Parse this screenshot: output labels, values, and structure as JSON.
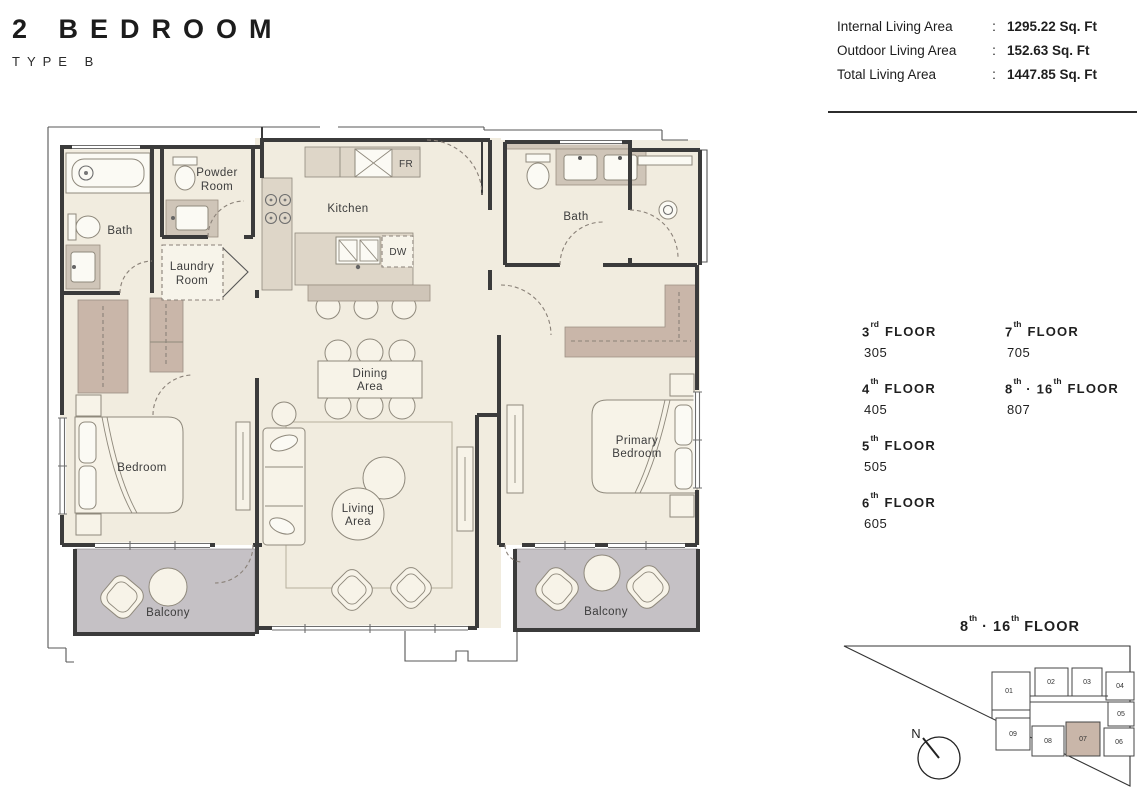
{
  "title": {
    "name": "2 BEDROOM",
    "type": "TYPE B"
  },
  "area_summary": [
    {
      "label": "Internal Living Area",
      "colon": ":",
      "value": "1295.22 Sq. Ft"
    },
    {
      "label": "Outdoor Living Area",
      "colon": ":",
      "value": "152.63 Sq. Ft"
    },
    {
      "label": "Total Living Area",
      "colon": ":",
      "value": "1447.85 Sq. Ft"
    }
  ],
  "floors": {
    "left": [
      {
        "num": "3",
        "ord": "rd",
        "word": "FLOOR",
        "unit": "305"
      },
      {
        "num": "4",
        "ord": "th",
        "word": "FLOOR",
        "unit": "405"
      },
      {
        "num": "5",
        "ord": "th",
        "word": "FLOOR",
        "unit": "505"
      },
      {
        "num": "6",
        "ord": "th",
        "word": "FLOOR",
        "unit": "605"
      }
    ],
    "right": [
      {
        "num": "7",
        "ord": "th",
        "word": "FLOOR",
        "unit": "705"
      },
      {
        "num": "8",
        "ord": "th",
        "sep": " · ",
        "num2": "16",
        "ord2": "th",
        "word": "FLOOR",
        "unit": "807"
      }
    ]
  },
  "keyplan": {
    "title": {
      "p1": "8",
      "s1": "th",
      "sep": " · ",
      "p2": "16",
      "s2": "th",
      "word": " FLOOR"
    },
    "north_label": "N",
    "units": [
      "01",
      "02",
      "03",
      "04",
      "05",
      "06",
      "07",
      "08",
      "09"
    ],
    "highlighted_unit": "07"
  },
  "plan_labels": {
    "bath_left": "Bath",
    "powder_1": "Powder",
    "powder_2": "Room",
    "laundry_1": "Laundry",
    "laundry_2": "Room",
    "kitchen": "Kitchen",
    "fridge": "FR",
    "dishwasher": "DW",
    "dining_1": "Dining",
    "dining_2": "Area",
    "living_1": "Living",
    "living_2": "Area",
    "bedroom": "Bedroom",
    "primary_1": "Primary",
    "primary_2": "Bedroom",
    "bath_right": "Bath",
    "balcony_left": "Balcony",
    "balcony_right": "Balcony"
  },
  "colors": {
    "wall": "#3b3b3b",
    "floor_cream": "#f1ecdf",
    "furniture_cream": "#f7f3e8",
    "counter_beige": "#ded6c8",
    "closet_taupe": "#c9b6a9",
    "balcony_gray": "#c5c1c5",
    "line_gray": "#8a8178",
    "text_dark": "#1f1f1f"
  }
}
